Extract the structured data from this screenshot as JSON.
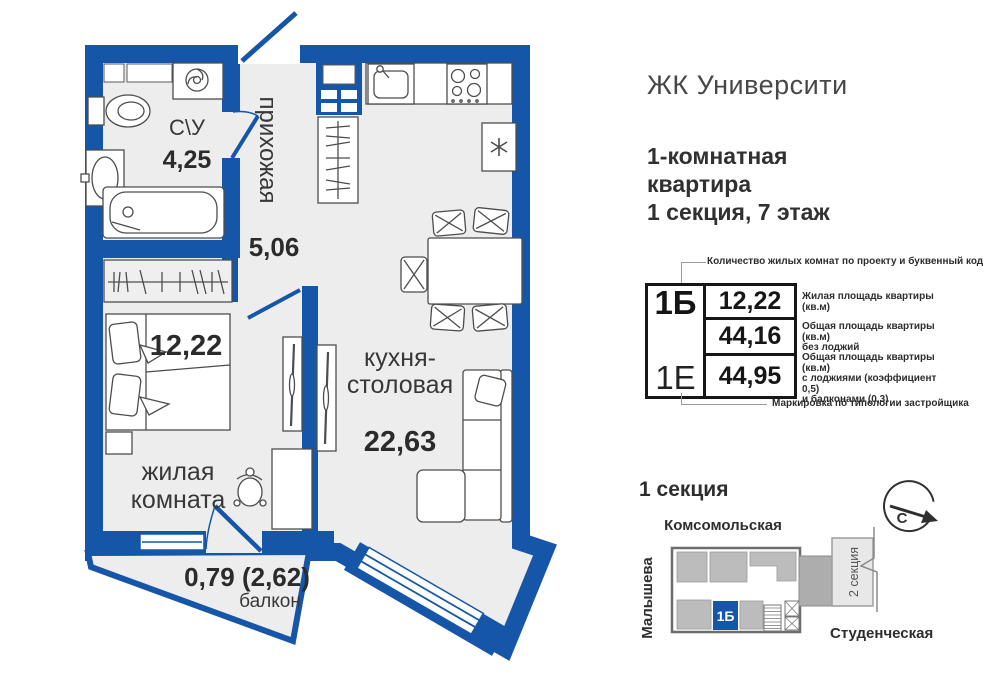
{
  "header": {
    "project_title": "ЖК Университи",
    "apartment_line1": "1-комнатная",
    "apartment_line2": "квартира",
    "apartment_line3": "1 секция, 7 этаж"
  },
  "plan": {
    "bathroom": {
      "label": "С\\У",
      "area": "4,25"
    },
    "hallway": {
      "label": "прихожая",
      "area": "5,06"
    },
    "living": {
      "label_line1": "жилая",
      "label_line2": "комната",
      "area": "12,22"
    },
    "kitchen": {
      "label_line1": "кухня-",
      "label_line2": "столовая",
      "area": "22,63"
    },
    "balcony": {
      "label": "балкон",
      "area": "0,79 (2,62)"
    }
  },
  "info_card": {
    "type_code": "1Б",
    "type_code_alt": "1Е",
    "top_note": "Количество жилых комнат по проекту и буквенный код",
    "bottom_note": "Маркировка по типологии застройщика",
    "rows": [
      {
        "value": "12,22",
        "note": "Жилая площадь квартиры (кв.м)"
      },
      {
        "value": "44,16",
        "note": "Общая площадь квартиры (кв.м)\nбез лоджий"
      },
      {
        "value": "44,95",
        "note": "Общая площадь квартиры (кв.м)\nс лоджиями (коэффициент 0,5)\nи балконами (0,3)"
      }
    ]
  },
  "section_map": {
    "title": "1 секция",
    "streets": {
      "top": "Комсомольская",
      "left": "Малышева",
      "bottom": "Студенческая"
    },
    "unit_marker": "1Б",
    "section2_label": "2 секция",
    "north_label": "С"
  },
  "colors": {
    "wall_blue": "#1556A8",
    "floor_gray": "#EDEDED",
    "marker_blue": "#1556A8"
  }
}
